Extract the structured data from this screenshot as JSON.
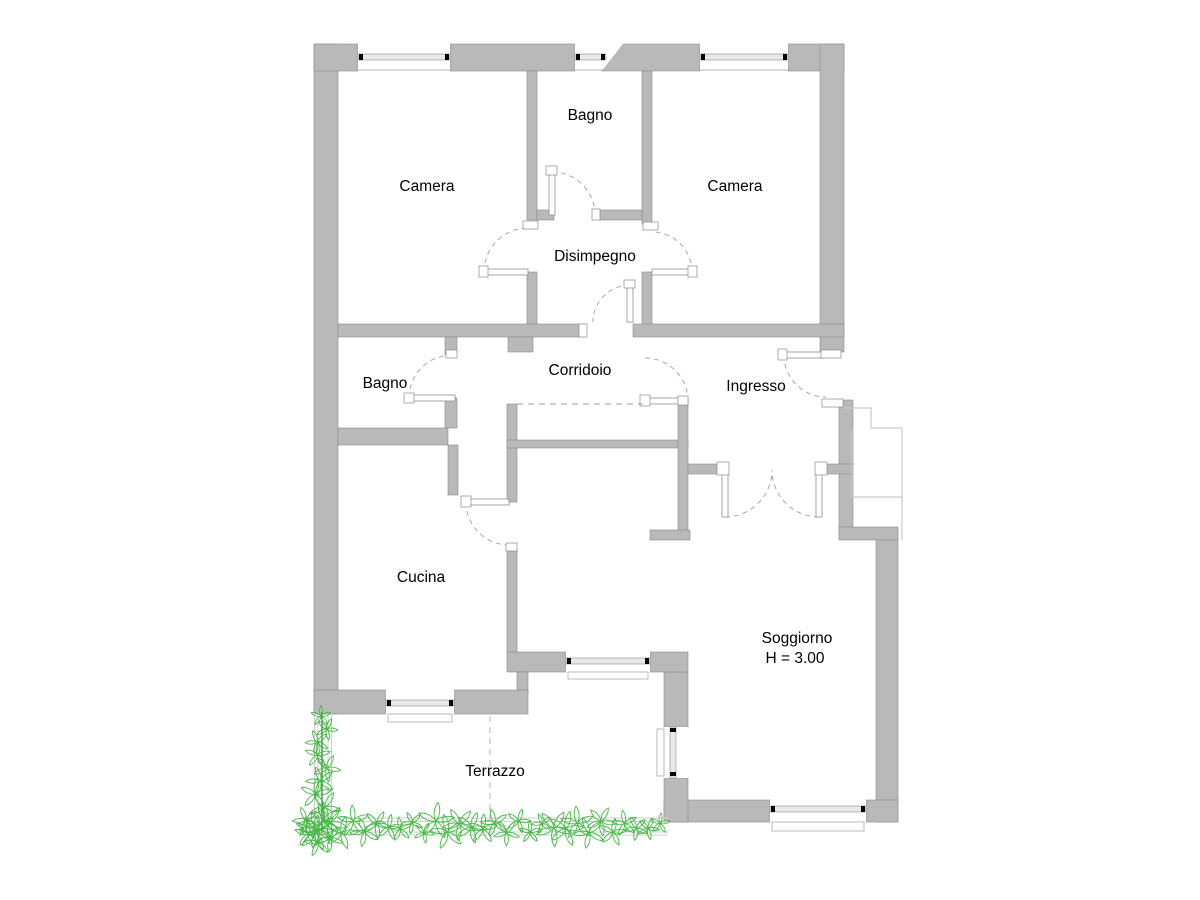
{
  "floor_plan": {
    "rooms": [
      {
        "id": "camera-left",
        "label": "Camera"
      },
      {
        "id": "bagno-top",
        "label": "Bagno"
      },
      {
        "id": "camera-right",
        "label": "Camera"
      },
      {
        "id": "disimpegno",
        "label": "Disimpegno"
      },
      {
        "id": "bagno-lower",
        "label": "Bagno"
      },
      {
        "id": "corridoio",
        "label": "Corridoio"
      },
      {
        "id": "ingresso",
        "label": "Ingresso"
      },
      {
        "id": "cucina",
        "label": "Cucina"
      },
      {
        "id": "soggiorno",
        "label": "Soggiorno",
        "ceiling_height": "H = 3.00"
      },
      {
        "id": "terrazzo",
        "label": "Terrazzo"
      }
    ],
    "colors": {
      "wall": "#b9b9b9",
      "wall_edge": "#8a8a8a",
      "window_frame": "#e8e8e8",
      "plant_green": "#46b846",
      "background": "#ffffff"
    }
  }
}
